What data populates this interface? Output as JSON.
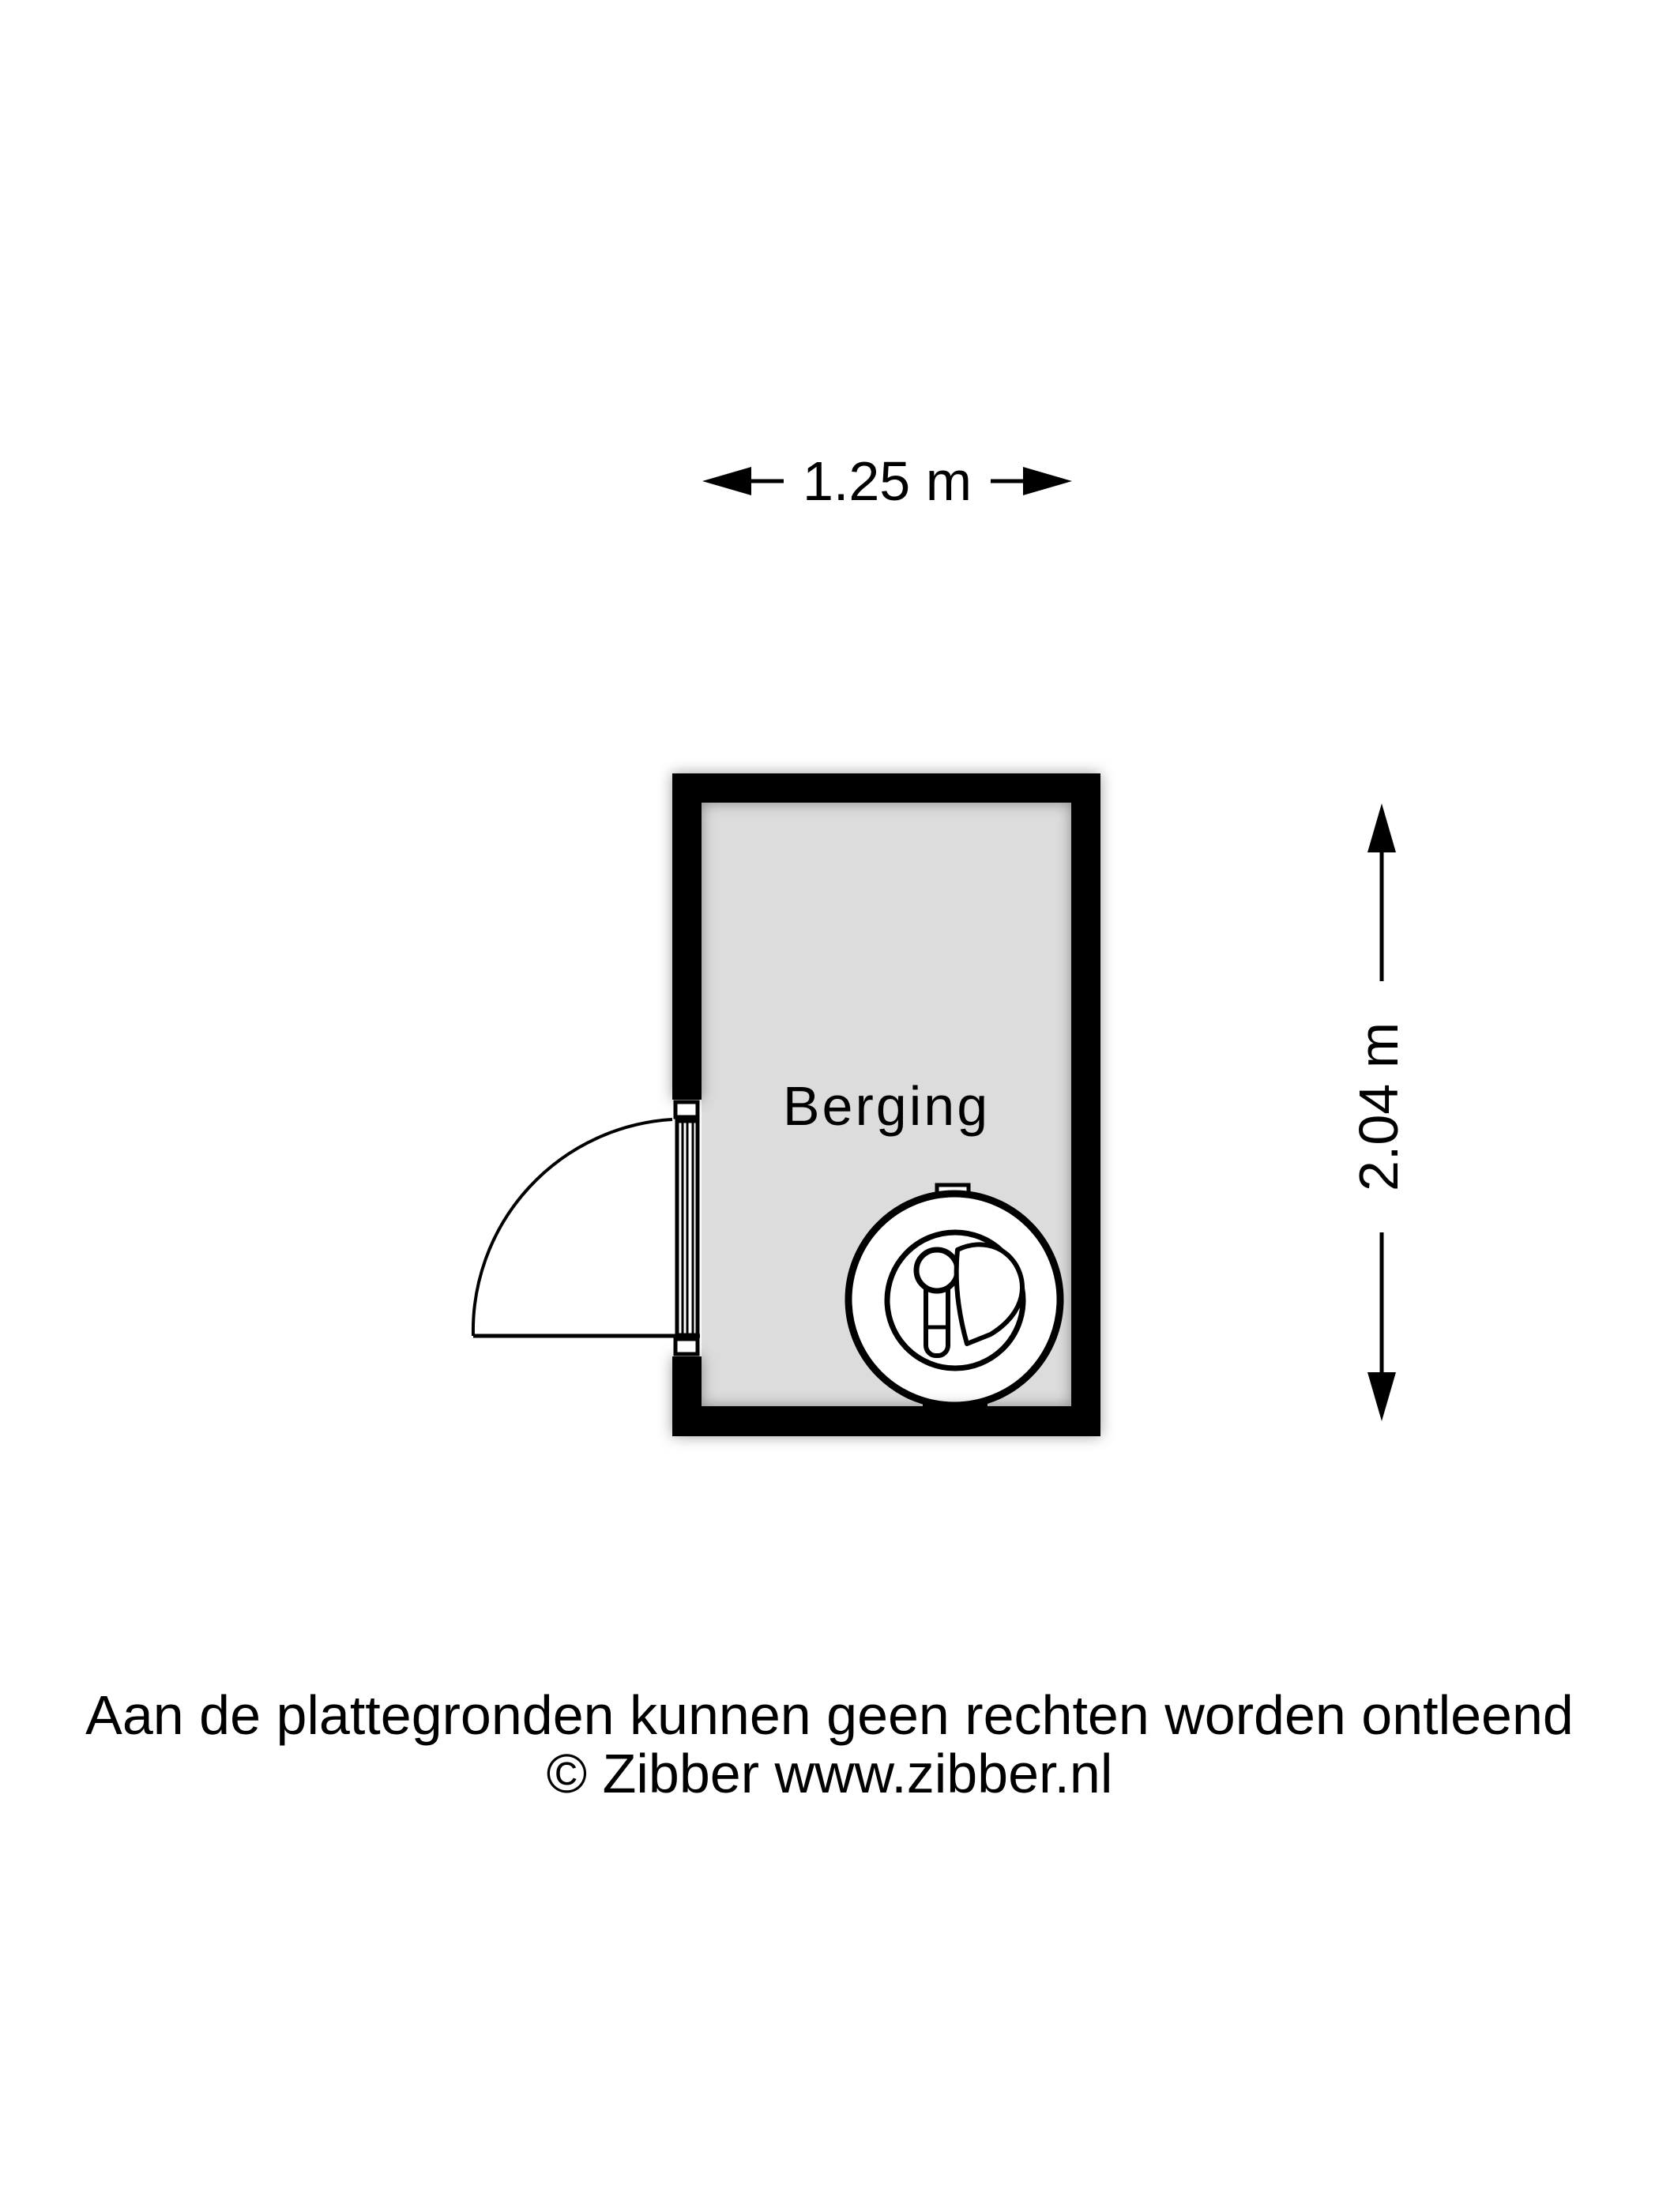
{
  "page": {
    "background_color": "#ffffff",
    "text_color": "#000000"
  },
  "room": {
    "name": "Berging",
    "floor_color": "#dcdcdc",
    "wall_color": "#000000"
  },
  "dimension_labels": {
    "width": {
      "label": "1.25 m",
      "meters": 1.25
    },
    "height": {
      "label": "2.04 m",
      "meters": 2.04
    }
  },
  "fixtures": {
    "washing_machine": "washing-machine-icon",
    "door": "door-swing-icon"
  },
  "footer": {
    "disclaimer": "Aan de plattegronden kunnen geen rechten worden ontleend",
    "copyright": "© Zibber www.zibber.nl"
  }
}
